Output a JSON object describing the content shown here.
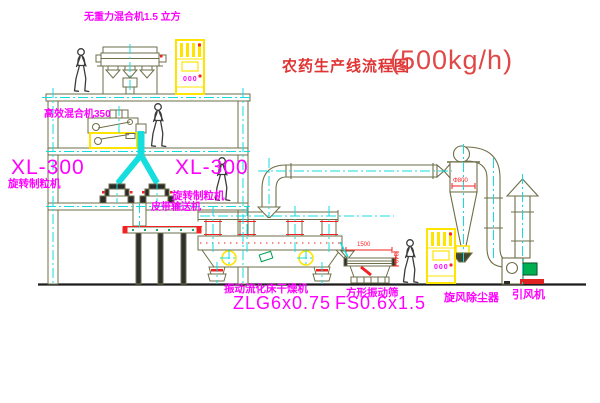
{
  "title": {
    "name": "农药生产线流程图",
    "capacity": "(500kg/h)"
  },
  "labels": {
    "gravity_mixer": "无重力混合机1.5 立方",
    "high_efficiency_mixer": "高效混合机350",
    "granulator_left_model": "XL-300",
    "granulator_left_name": "旋转制粒机",
    "granulator_right_model": "XL-300",
    "granulator_right_name": "旋转制粒机",
    "belt_conveyor": "皮带输送机",
    "fluid_bed_dryer_name": "振动流化床干燥机",
    "fluid_bed_dryer_model": "ZLG6x0.75",
    "vibrating_screen_name": "方形振动筛",
    "vibrating_screen_model": "FS0.6x1.5",
    "cyclone_name": "旋风除尘器",
    "fan_name": "引风机"
  },
  "displays": {
    "control_cabinet_top": "000",
    "control_cabinet_bottom": "000"
  },
  "dimensions": {
    "cyclone_diameter": "Φ800",
    "screen_length": "1500",
    "screen_height": "340"
  },
  "colors": {
    "outline": "#6e6e48",
    "centerline": "#12dcdc",
    "highlight_yellow": "#ffe400",
    "label_magenta": "#ff00ff",
    "title_red": "#e03434",
    "dimension_red": "#ff2222",
    "motor_green": "#00b050"
  }
}
